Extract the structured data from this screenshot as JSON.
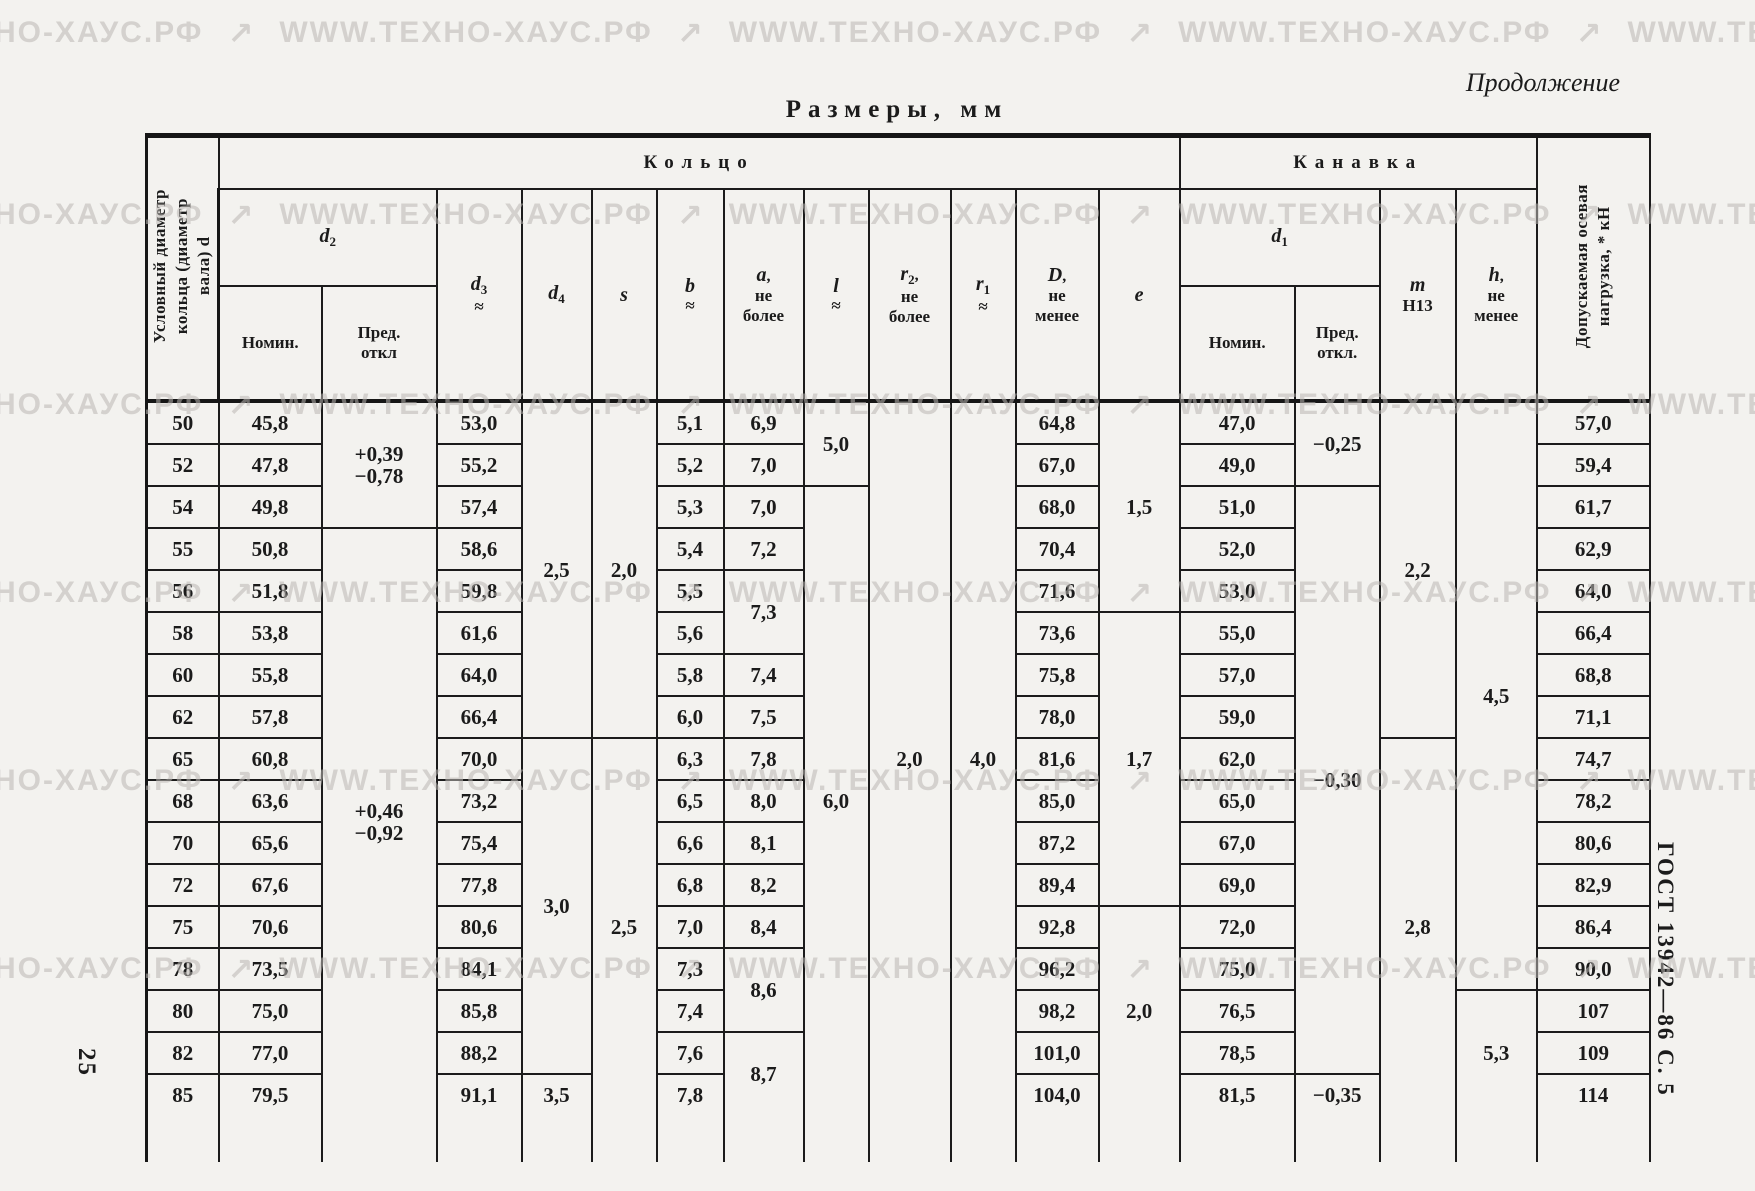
{
  "page": {
    "continuation_label": "Продолжение",
    "title": "Размеры, мм",
    "page_number": "25",
    "doc_reference": "ГОСТ 13942—86 С. 5",
    "watermark": {
      "text": "WWW.ТЕХНО-ХАУС.РФ",
      "separator": "↗",
      "repeats": 5
    }
  },
  "table": {
    "groups": {
      "ring": "Кольцо",
      "groove": "Канавка"
    },
    "corner_header": "Условный диаметр\nкольца (диаметр\nвала) d",
    "load_header": "Допускаемая осевая\nнагрузка, * кН",
    "headers": {
      "d2": {
        "letter": "d",
        "sub": "2"
      },
      "d1": {
        "letter": "d",
        "sub": "1"
      },
      "nominal_ring": "Номин.",
      "deviation_ring": "Пред.\nоткл",
      "nominal_groove": "Номин.",
      "deviation_groove": "Пред.\nоткл.",
      "d3": {
        "letter": "d",
        "sub": "3",
        "approx": "≈"
      },
      "d4": {
        "letter": "d",
        "sub": "4"
      },
      "s": {
        "letter": "s"
      },
      "b": {
        "letter": "b",
        "approx": "≈"
      },
      "a": {
        "letter": "a",
        "comma": ",",
        "rest": "не\nболее"
      },
      "l": {
        "letter": "l",
        "approx": "≈"
      },
      "r2": {
        "letter": "r",
        "sub": "2",
        "comma": ",",
        "rest": "не\nболее"
      },
      "r1": {
        "letter": "r",
        "sub": "1",
        "approx": "≈"
      },
      "D": {
        "letter": "D",
        "comma": ",",
        "rest": "не\nменее"
      },
      "e": {
        "letter": "e"
      },
      "m": {
        "letter": "m",
        "rest": "Н13"
      },
      "h": {
        "letter": "h",
        "comma": ",",
        "rest": "не\nменее"
      }
    },
    "rows": [
      [
        {
          "v": "50"
        },
        {
          "v": "45,8"
        },
        {
          "v": [
            "+0,39",
            "−0,78"
          ],
          "rs": 3
        },
        {
          "v": "53,0"
        },
        {
          "v": "2,5",
          "rs": 8
        },
        {
          "v": "2,0",
          "rs": 8
        },
        {
          "v": "5,1"
        },
        {
          "v": "6,9"
        },
        {
          "v": "5,0",
          "rs": 2
        },
        {
          "v": "2,0",
          "rs": 17,
          "nb": true
        },
        {
          "v": "4,0",
          "rs": 17,
          "nb": true
        },
        {
          "v": "64,8"
        },
        {
          "v": "1,5",
          "rs": 5
        },
        {
          "v": "47,0"
        },
        {
          "v": "−0,25",
          "rs": 2
        },
        {
          "v": "2,2",
          "rs": 8
        },
        {
          "v": "4,5",
          "rs": 14
        },
        {
          "v": "57,0"
        }
      ],
      [
        {
          "v": "52"
        },
        {
          "v": "47,8"
        },
        {
          "v": "55,2"
        },
        {
          "v": "5,2"
        },
        {
          "v": "7,0"
        },
        {
          "v": "67,0"
        },
        {
          "v": "49,0"
        },
        {
          "v": "59,4"
        }
      ],
      [
        {
          "v": "54"
        },
        {
          "v": "49,8"
        },
        {
          "v": "57,4"
        },
        {
          "v": "5,3"
        },
        {
          "v": "7,0"
        },
        {
          "v": "6,0",
          "rs": 15,
          "nb": true
        },
        {
          "v": "68,0"
        },
        {
          "v": "51,0"
        },
        {
          "v": "−0,30",
          "rs": 14
        },
        {
          "v": "61,7"
        }
      ],
      [
        {
          "v": "55"
        },
        {
          "v": "50,8"
        },
        {
          "v": [
            "+0,46",
            "−0,92"
          ],
          "rs": 14,
          "nb": true
        },
        {
          "v": "58,6"
        },
        {
          "v": "5,4"
        },
        {
          "v": "7,2"
        },
        {
          "v": "70,4"
        },
        {
          "v": "52,0"
        },
        {
          "v": "62,9"
        }
      ],
      [
        {
          "v": "56"
        },
        {
          "v": "51,8"
        },
        {
          "v": "59,8"
        },
        {
          "v": "5,5"
        },
        {
          "v": "7,3",
          "rs": 2
        },
        {
          "v": "71,6"
        },
        {
          "v": "53,0"
        },
        {
          "v": "64,0"
        }
      ],
      [
        {
          "v": "58"
        },
        {
          "v": "53,8"
        },
        {
          "v": "61,6"
        },
        {
          "v": "5,6"
        },
        {
          "v": "73,6"
        },
        {
          "v": "1,7",
          "rs": 7
        },
        {
          "v": "55,0"
        },
        {
          "v": "66,4"
        }
      ],
      [
        {
          "v": "60"
        },
        {
          "v": "55,8"
        },
        {
          "v": "64,0"
        },
        {
          "v": "5,8"
        },
        {
          "v": "7,4"
        },
        {
          "v": "75,8"
        },
        {
          "v": "57,0"
        },
        {
          "v": "68,8"
        }
      ],
      [
        {
          "v": "62"
        },
        {
          "v": "57,8"
        },
        {
          "v": "66,4"
        },
        {
          "v": "6,0"
        },
        {
          "v": "7,5"
        },
        {
          "v": "78,0"
        },
        {
          "v": "59,0"
        },
        {
          "v": "71,1"
        }
      ],
      [
        {
          "v": "65"
        },
        {
          "v": "60,8"
        },
        {
          "v": "70,0"
        },
        {
          "v": "3,0",
          "rs": 8
        },
        {
          "v": "2,5",
          "rs": 9,
          "nb": true
        },
        {
          "v": "6,3"
        },
        {
          "v": "7,8"
        },
        {
          "v": "81,6"
        },
        {
          "v": "62,0"
        },
        {
          "v": "2,8",
          "rs": 9,
          "nb": true
        },
        {
          "v": "74,7"
        }
      ],
      [
        {
          "v": "68"
        },
        {
          "v": "63,6"
        },
        {
          "v": "73,2"
        },
        {
          "v": "6,5"
        },
        {
          "v": "8,0"
        },
        {
          "v": "85,0"
        },
        {
          "v": "65,0"
        },
        {
          "v": "78,2"
        }
      ],
      [
        {
          "v": "70"
        },
        {
          "v": "65,6"
        },
        {
          "v": "75,4"
        },
        {
          "v": "6,6"
        },
        {
          "v": "8,1"
        },
        {
          "v": "87,2"
        },
        {
          "v": "67,0"
        },
        {
          "v": "80,6"
        }
      ],
      [
        {
          "v": "72"
        },
        {
          "v": "67,6"
        },
        {
          "v": "77,8"
        },
        {
          "v": "6,8"
        },
        {
          "v": "8,2"
        },
        {
          "v": "89,4"
        },
        {
          "v": "69,0"
        },
        {
          "v": "82,9"
        }
      ],
      [
        {
          "v": "75"
        },
        {
          "v": "70,6"
        },
        {
          "v": "80,6"
        },
        {
          "v": "7,0"
        },
        {
          "v": "8,4"
        },
        {
          "v": "92,8"
        },
        {
          "v": "2,0",
          "rs": 5,
          "nb": true
        },
        {
          "v": "72,0"
        },
        {
          "v": "86,4"
        }
      ],
      [
        {
          "v": "78"
        },
        {
          "v": "73,5"
        },
        {
          "v": "84,1"
        },
        {
          "v": "7,3"
        },
        {
          "v": "8,6",
          "rs": 2
        },
        {
          "v": "96,2"
        },
        {
          "v": "75,0"
        },
        {
          "v": "90,0"
        }
      ],
      [
        {
          "v": "80"
        },
        {
          "v": "75,0"
        },
        {
          "v": "85,8"
        },
        {
          "v": "7,4"
        },
        {
          "v": "98,2"
        },
        {
          "v": "76,5"
        },
        {
          "v": "5,3",
          "rs": 3,
          "nb": true
        },
        {
          "v": "107"
        }
      ],
      [
        {
          "v": "82"
        },
        {
          "v": "77,0"
        },
        {
          "v": "88,2"
        },
        {
          "v": "7,6"
        },
        {
          "v": "8,7",
          "rs": 2,
          "nb": true
        },
        {
          "v": "101,0"
        },
        {
          "v": "78,5"
        },
        {
          "v": "109"
        }
      ],
      [
        {
          "v": "85",
          "nb": true
        },
        {
          "v": "79,5",
          "nb": true
        },
        {
          "v": "91,1",
          "nb": true
        },
        {
          "v": "3,5",
          "nb": true
        },
        {
          "v": "7,8",
          "nb": true
        },
        {
          "v": "104,0",
          "nb": true
        },
        {
          "v": "81,5",
          "nb": true
        },
        {
          "v": "−0,35",
          "nb": true
        },
        {
          "v": "114",
          "nb": true
        }
      ]
    ],
    "column_count": 18
  }
}
